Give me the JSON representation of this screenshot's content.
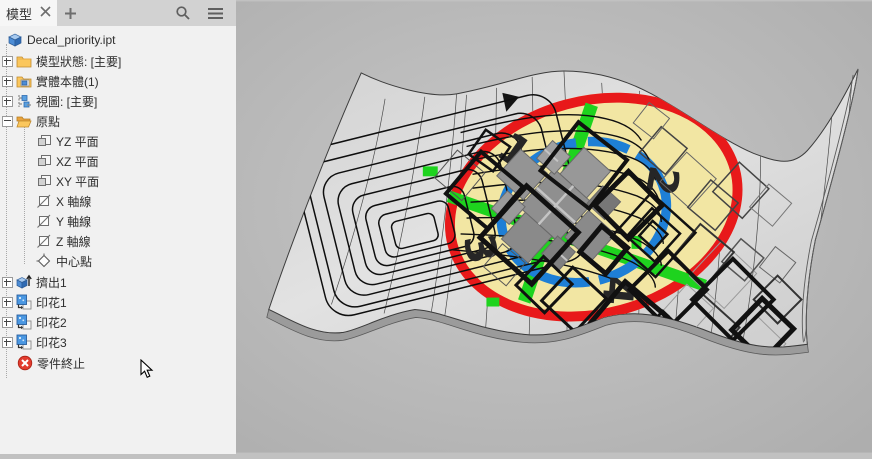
{
  "window": {
    "tab_title": "模型"
  },
  "browser": {
    "items": [
      {
        "label": "Decal_priority.ipt",
        "icon": "part-document-icon",
        "expander": "none",
        "level": 0
      },
      {
        "label": "模型狀態: [主要]",
        "icon": "folder-icon",
        "expander": "plus",
        "level": 1
      },
      {
        "label": "實體本體(1)",
        "icon": "solid-folder-icon",
        "expander": "plus",
        "level": 1
      },
      {
        "label": "視圖: [主要]",
        "icon": "view-rep-icon",
        "expander": "plus",
        "level": 1
      },
      {
        "label": "原點",
        "icon": "open-folder-icon",
        "expander": "minus",
        "level": 1
      },
      {
        "label": "YZ 平面",
        "icon": "plane-icon",
        "expander": "none",
        "level": 2
      },
      {
        "label": "XZ 平面",
        "icon": "plane-icon",
        "expander": "none",
        "level": 2
      },
      {
        "label": "XY 平面",
        "icon": "plane-icon",
        "expander": "none",
        "level": 2
      },
      {
        "label": "X 軸線",
        "icon": "axis-icon",
        "expander": "none",
        "level": 2
      },
      {
        "label": "Y 軸線",
        "icon": "axis-icon",
        "expander": "none",
        "level": 2
      },
      {
        "label": "Z 軸線",
        "icon": "axis-icon",
        "expander": "none",
        "level": 2
      },
      {
        "label": "中心點",
        "icon": "center-point-icon",
        "expander": "none",
        "level": 2
      },
      {
        "label": "擠出1",
        "icon": "extrude-icon",
        "expander": "plus",
        "level": 1
      },
      {
        "label": "印花1",
        "icon": "decal-icon",
        "expander": "plus",
        "level": 1
      },
      {
        "label": "印花2",
        "icon": "decal-icon",
        "expander": "plus",
        "level": 1
      },
      {
        "label": "印花3",
        "icon": "decal-icon",
        "expander": "plus",
        "level": 1
      },
      {
        "label": "零件終止",
        "icon": "end-of-part-icon",
        "expander": "none",
        "level": 1
      }
    ]
  },
  "viewport": {
    "decal_numbers": [
      "1",
      "2",
      "3",
      "4"
    ],
    "colors": {
      "decal_ring": "#e8191a",
      "decal_fill": "#f2e6a3",
      "ring_blue": "#1e7fd6",
      "cross_green": "#1ed31e",
      "surface": "#dbdbdb",
      "background": "#bfbfbf"
    }
  }
}
